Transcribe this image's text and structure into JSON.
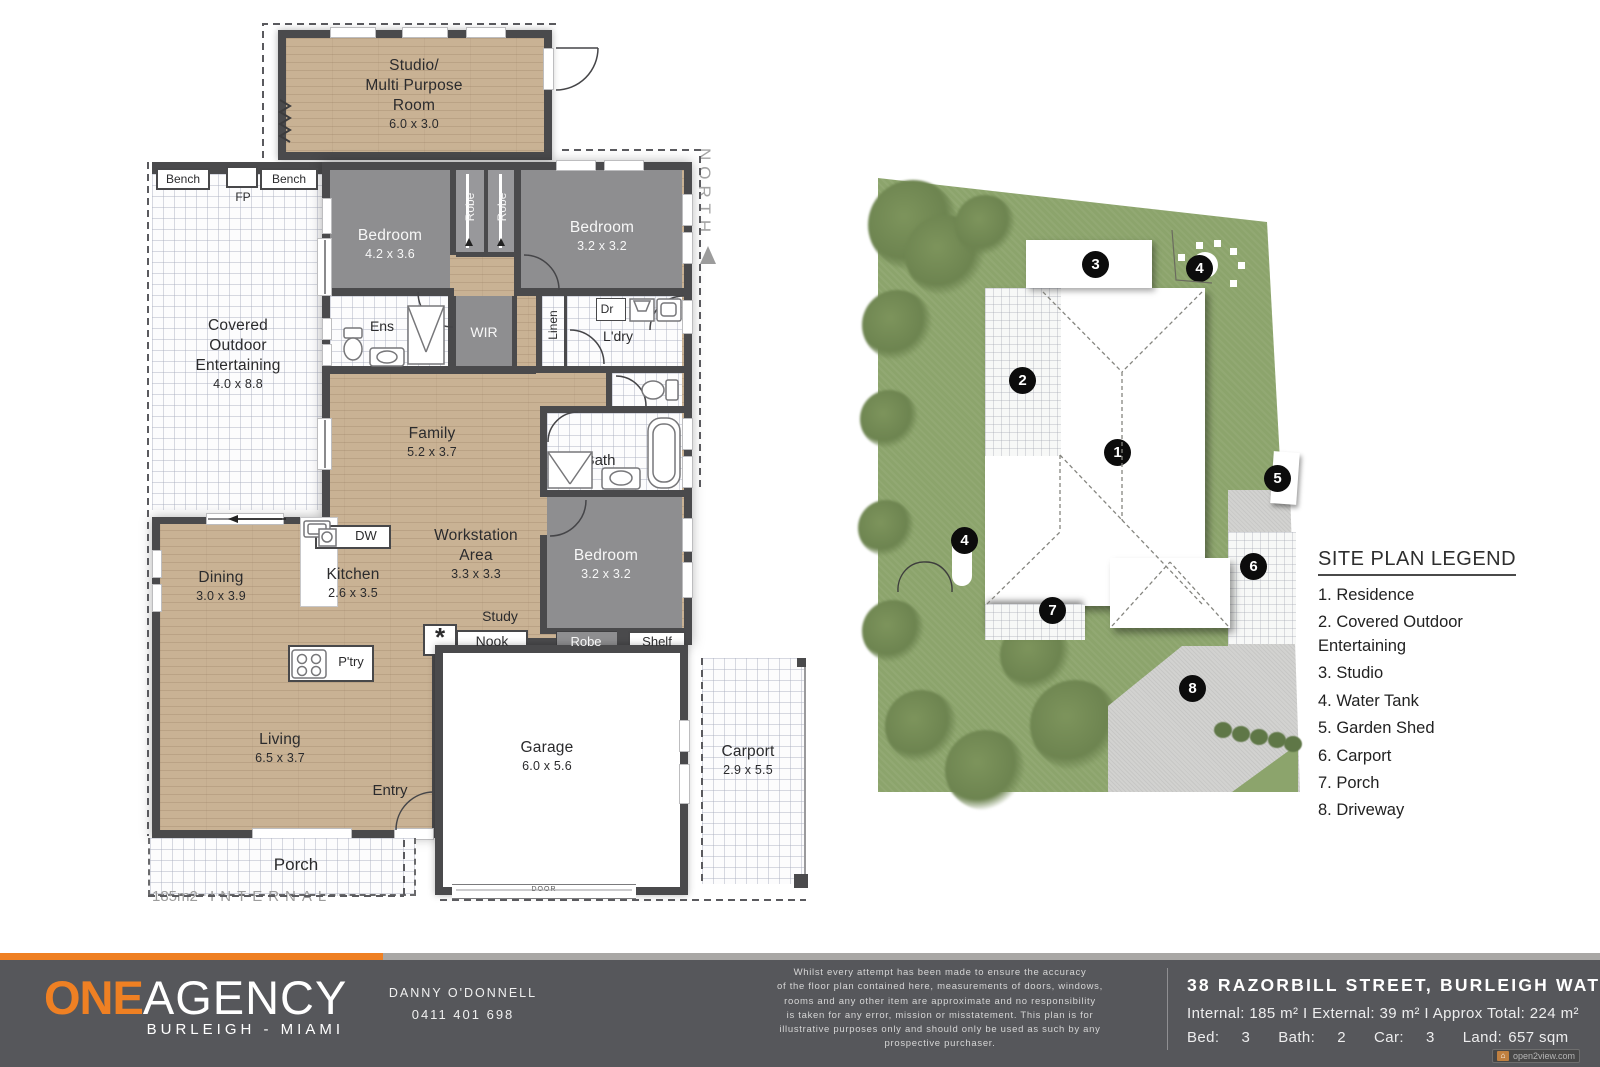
{
  "colors": {
    "accent_orange": "#ef8023",
    "wall": "#4a4a4c",
    "bedroom_gray": "#8e8e90",
    "wood_floor": "#c9b294",
    "grass_green": "#8ca46c",
    "driveway_gray": "#d2d2d0",
    "footer_gray": "#56575b"
  },
  "floor_plan": {
    "north": "NORTH",
    "area_note_value": "185m2",
    "area_note_label": "INTERNAL",
    "studio": {
      "l1": "Studio/",
      "l2": "Multi Purpose",
      "l3": "Room",
      "dims": "6.0 x 3.0"
    },
    "covered": {
      "l1": "Covered",
      "l2": "Outdoor",
      "l3": "Entertaining",
      "dims": "4.0 x 8.8"
    },
    "bedroom1": {
      "name": "Bedroom",
      "dims": "4.2 x 3.6"
    },
    "bedroom2": {
      "name": "Bedroom",
      "dims": "3.2 x 3.2"
    },
    "bedroom3": {
      "name": "Bedroom",
      "dims": "3.2 x 3.2"
    },
    "family": {
      "name": "Family",
      "dims": "5.2 x 3.7"
    },
    "workstation": {
      "l1": "Workstation",
      "l2": "Area",
      "dims": "3.3 x 3.3"
    },
    "dining": {
      "name": "Dining",
      "dims": "3.0 x 3.9"
    },
    "kitchen": {
      "name": "Kitchen",
      "dims": "2.6 x 3.5"
    },
    "living": {
      "name": "Living",
      "dims": "6.5 x 3.7"
    },
    "garage": {
      "name": "Garage",
      "dims": "6.0 x 5.6"
    },
    "carport": {
      "name": "Carport",
      "dims": "2.9 x 5.5"
    },
    "porch": "Porch",
    "entry": "Entry",
    "bench_left": "Bench",
    "bench_right": "Bench",
    "fp": "FP",
    "robe_a": "Robe",
    "robe_b": "Robe",
    "robe_c": "Robe",
    "ens": "Ens",
    "wir": "WIR",
    "linen": "Linen",
    "dr": "Dr",
    "ldry": "L'dry",
    "bath": "Bath",
    "study": "Study",
    "nook": "Nook",
    "shelf": "Shelf",
    "dw": "DW",
    "ptry": "P'try",
    "asterisk": "*",
    "door": "DOOR"
  },
  "site_plan": {
    "markers": {
      "m1": "1",
      "m2": "2",
      "m3": "3",
      "m4a": "4",
      "m4b": "4",
      "m5": "5",
      "m6": "6",
      "m7": "7",
      "m8": "8"
    }
  },
  "legend": {
    "title": "SITE PLAN LEGEND",
    "items": [
      "1. Residence",
      "2. Covered Outdoor Entertaining",
      "3. Studio",
      "4. Water Tank",
      "5. Garden Shed",
      "6. Carport",
      "7. Porch",
      "8. Driveway"
    ]
  },
  "footer": {
    "logo_one": "ONE",
    "logo_agency": "AGENCY",
    "logo_location": "BURLEIGH - MIAMI",
    "agent_name": "DANNY O'DONNELL",
    "agent_phone": "0411 401 698",
    "disclaimer": [
      "Whilst every attempt has been made to ensure the accuracy",
      "of the floor plan contained here, measurements of doors, windows,",
      "rooms and any other item are approximate and no responsibility",
      "is taken for any error, mission or misstatement. This plan is for",
      "illustrative purposes only and should only be used as such by any",
      "prospective purchaser."
    ],
    "address": "38 RAZORBILL STREET, BURLEIGH WATERS",
    "areas": "Internal: 185 m² I External: 39 m² I Approx Total: 224 m²",
    "stats": {
      "bed_label": "Bed:",
      "bed": "3",
      "bath_label": "Bath:",
      "bath": "2",
      "car_label": "Car:",
      "car": "3",
      "land_label": "Land:",
      "land": "657 sqm"
    },
    "badge": "open2view.com"
  }
}
